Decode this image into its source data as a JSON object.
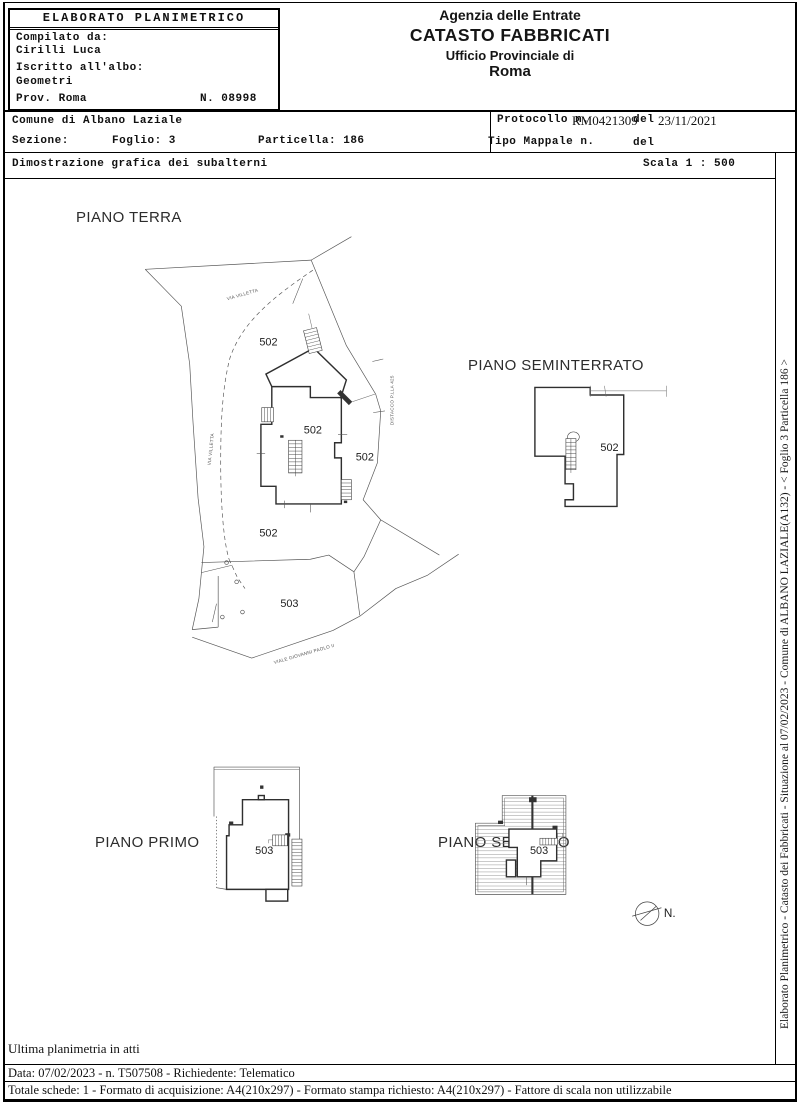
{
  "header": {
    "left": {
      "title": "ELABORATO PLANIMETRICO",
      "compilato_label": "Compilato da:",
      "compilato_value": "Cirilli Luca",
      "albo_label": "Iscritto all'albo:",
      "albo_value": "Geometri",
      "prov": "Prov. Roma",
      "numero": "N. 08998"
    },
    "right": {
      "line1": "Agenzia delle Entrate",
      "line2": "CATASTO FABBRICATI",
      "line3": "Ufficio Provinciale di",
      "line4": "Roma"
    }
  },
  "info": {
    "comune": "Comune di Albano Laziale",
    "sezione_label": "Sezione:",
    "foglio": "Foglio: 3",
    "particella": "Particella: 186",
    "protocollo_label": "Protocollo n.",
    "protocollo_value": "RM0421309",
    "del_label": "del",
    "protocollo_date": "23/11/2021",
    "tipo_mappale_label": "Tipo Mappale n.",
    "tipo_mappale_del": "del",
    "dimostrazione": "Dimostrazione grafica dei subalterni",
    "scala": "Scala 1 : 500"
  },
  "drawing": {
    "floors": {
      "terra": {
        "title": "PIANO TERRA",
        "unit_labels": [
          "502",
          "502",
          "502",
          "502",
          "503"
        ],
        "street_top": "VIA VILLETTA",
        "street_left": "VIA VILLETTA",
        "street_bottom": "VIALE GIOVANNI PAOLO II",
        "boundary_right": "DISTACCO P.LLA 425"
      },
      "seminterrato": {
        "title": "PIANO SEMINTERRATO",
        "unit_labels": [
          "502"
        ]
      },
      "primo": {
        "title": "PIANO PRIMO",
        "unit_labels": [
          "503"
        ]
      },
      "secondo": {
        "title": "PIANO SECONDO",
        "unit_labels": [
          "503"
        ]
      }
    },
    "north_label": "N."
  },
  "side_strip": {
    "text": "Elaborato Planimetrico - Catasto dei Fabbricati - Situazione al 07/02/2023 - Comune di ALBANO LAZIALE(A132) - < Foglio 3 Particella 186 >"
  },
  "footer": {
    "ultima": "Ultima planimetria in atti",
    "riga_data": "Data: 07/02/2023 - n. T507508 - Richiedente: Telematico",
    "riga_totale": "Totale schede: 1 - Formato di acquisizione: A4(210x297)  - Formato stampa richiesto: A4(210x297) - Fattore di scala non utilizzabile"
  }
}
